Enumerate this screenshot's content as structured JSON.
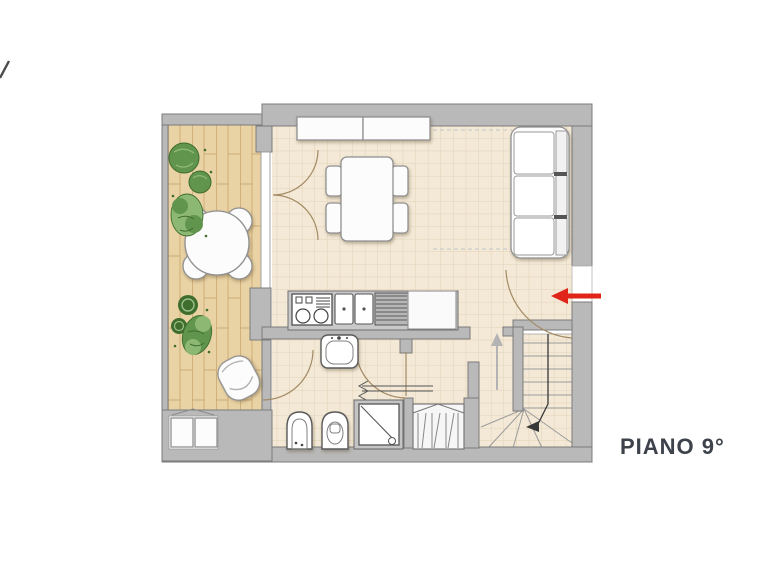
{
  "page": {
    "background": "#ffffff"
  },
  "branding": {
    "corner_mark_shape": "diagonal-slash"
  },
  "floor_plan": {
    "label": "PIANO 9°",
    "palette": {
      "page_bg": "#ffffff",
      "wall": "#b9b9b9",
      "wall_edge": "#7c7c7c",
      "tile_floor": "#f3e9d6",
      "tile_grid": "#e2d3b8",
      "wood_floor": "#e9d2a4",
      "wood_grain": "#c8a76f",
      "furniture_fill": "#fcfcfc",
      "furniture_stroke": "#909090",
      "fixture_stroke": "#5a5a5a",
      "door_arc": "#a28a64",
      "plant_dark": "#3f6d2e",
      "plant_mid": "#61944d",
      "plant_light": "#8cb873",
      "stair_line": "#9b9b9b",
      "direction_line": "#383838",
      "up_arrow": "#b3b3b3",
      "dashed_line": "#cccccc",
      "entrance_arrow": "#e02418",
      "label_color": "#3d424b"
    },
    "elements": {
      "rooms": [
        "terrace",
        "living-room-with-kitchen",
        "bathroom",
        "shower-lobby",
        "stairwell"
      ],
      "furniture": [
        "terrace-round-table-with-chairs",
        "terrace-plants",
        "terrace-lounge-chair",
        "terrace-ac-units",
        "sideboard-cabinet",
        "dining-table-with-four-chairs",
        "three-seat-sofa",
        "kitchen-counter-cooktop-sinks-drainer",
        "washbasin",
        "bidet",
        "toilet",
        "shower",
        "wardrobe-closet",
        "staircase-with-winders"
      ],
      "annotations": [
        "entrance-red-arrow",
        "stair-direction-arrow",
        "up-direction-arrow",
        "ceiling-dashed-lines",
        "shower-sliding-door"
      ]
    }
  }
}
